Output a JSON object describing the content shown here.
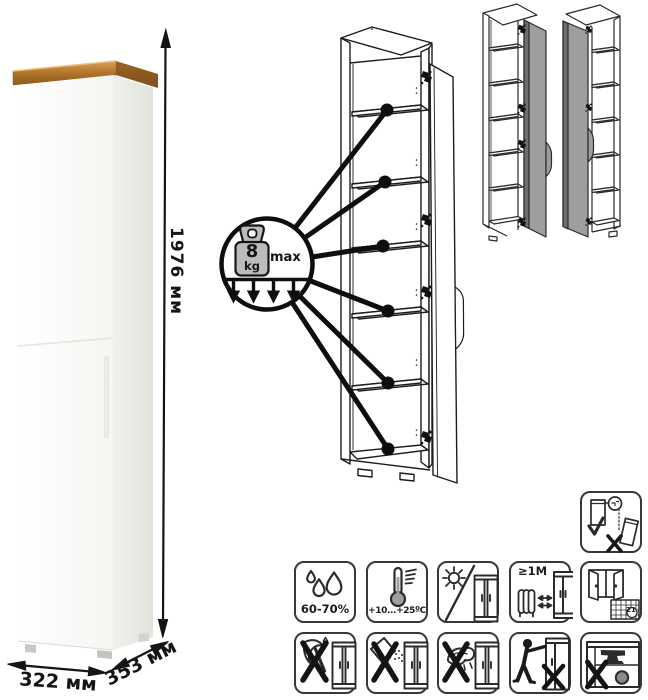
{
  "sheet": {
    "type": "wardrobe-dimension-and-care-sheet"
  },
  "dimensions": {
    "height": "1976 мм",
    "width": "322 мм",
    "depth": "353 мм"
  },
  "shelf_load": {
    "value": "8",
    "unit": "kg",
    "qualifier": "max"
  },
  "care": {
    "humidity": "60-70%",
    "temperature": "+10...+25ºC",
    "heat_distance": "≥1М",
    "calendar_day": "21"
  },
  "icon_names": {
    "standalone": [
      "secure-to-wall-icon"
    ],
    "row1": [
      "humidity-icon",
      "temperature-range-icon",
      "no-direct-sunlight-icon",
      "heat-source-distance-icon",
      "ventilation-icon"
    ],
    "row2": [
      "no-sharp-tools-icon",
      "no-abrasive-cleaners-icon",
      "no-wet-cleaning-icon",
      "no-dragging-icon",
      "no-overloading-icon"
    ]
  },
  "colors": {
    "wood_top": "#b5782e",
    "door_gray": "#9e9e9e",
    "line_art": "#1c1c1c"
  }
}
